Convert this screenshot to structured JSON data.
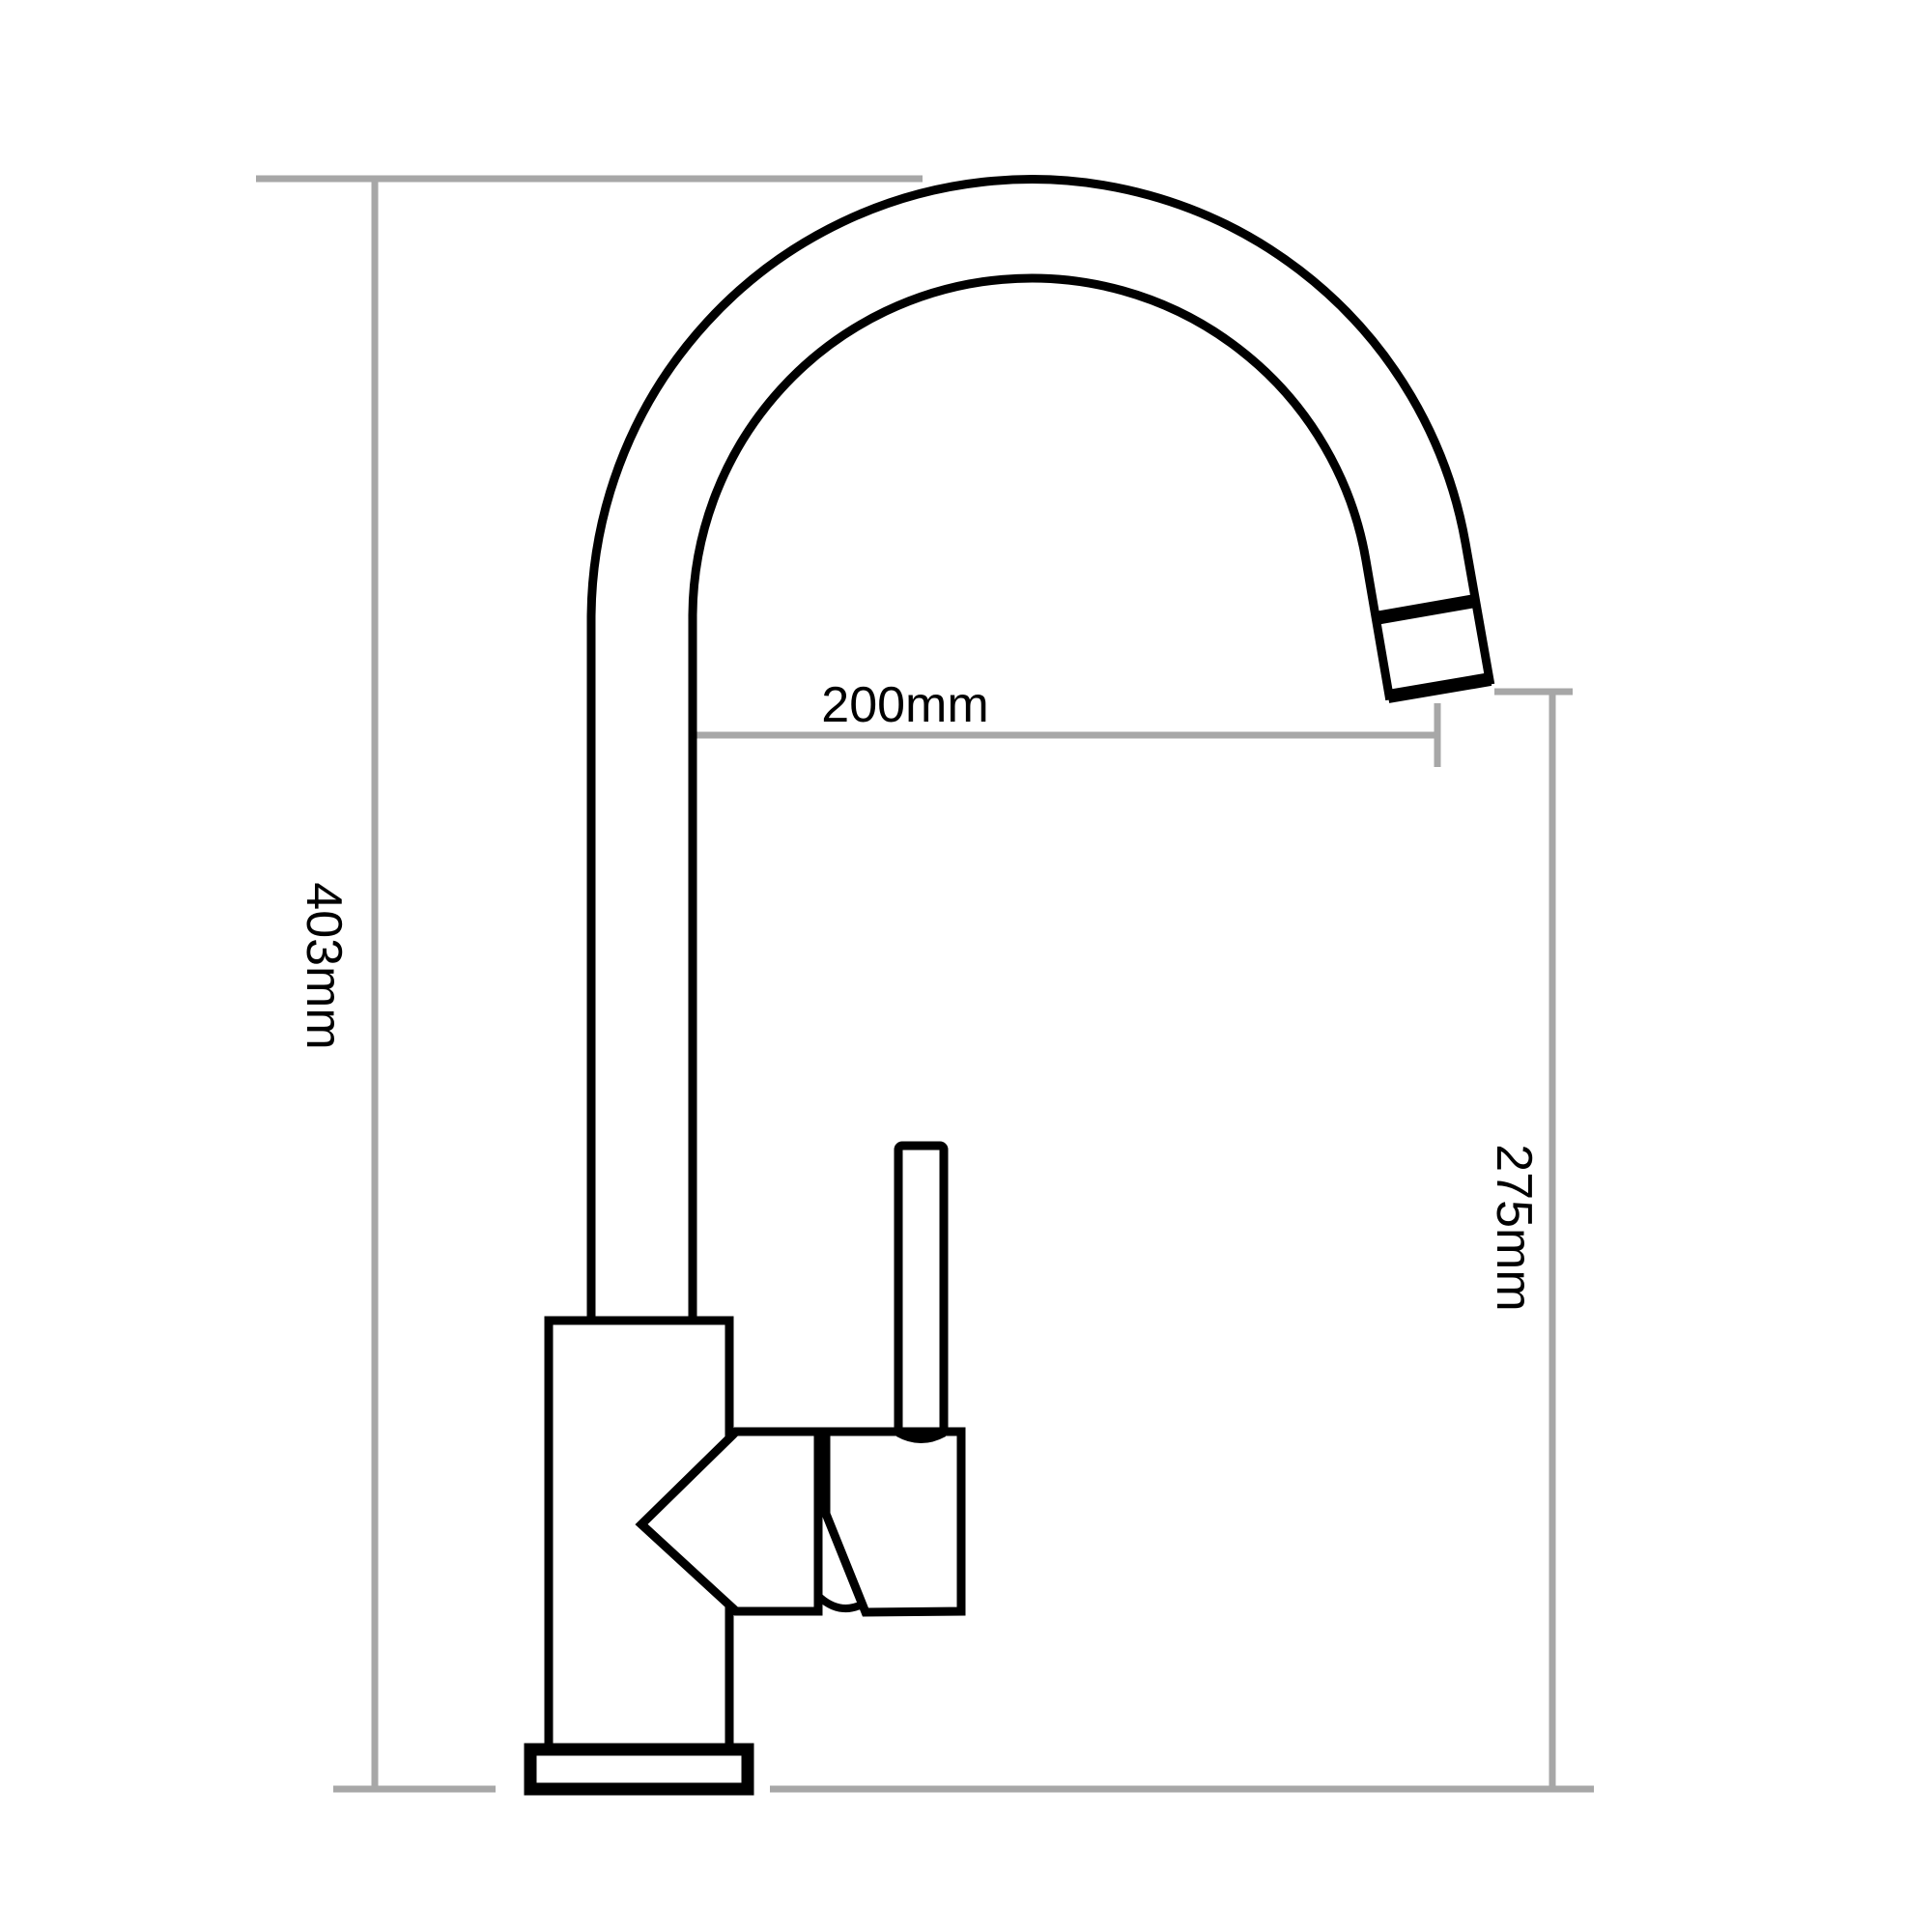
{
  "colors": {
    "outline": "#000000",
    "dimension_line": "#a7a7a7",
    "label_text": "#000000",
    "fill": "#ffffff"
  },
  "labels": {
    "overall_height": "403mm",
    "spout_reach": "200mm",
    "spout_height": "275mm"
  }
}
